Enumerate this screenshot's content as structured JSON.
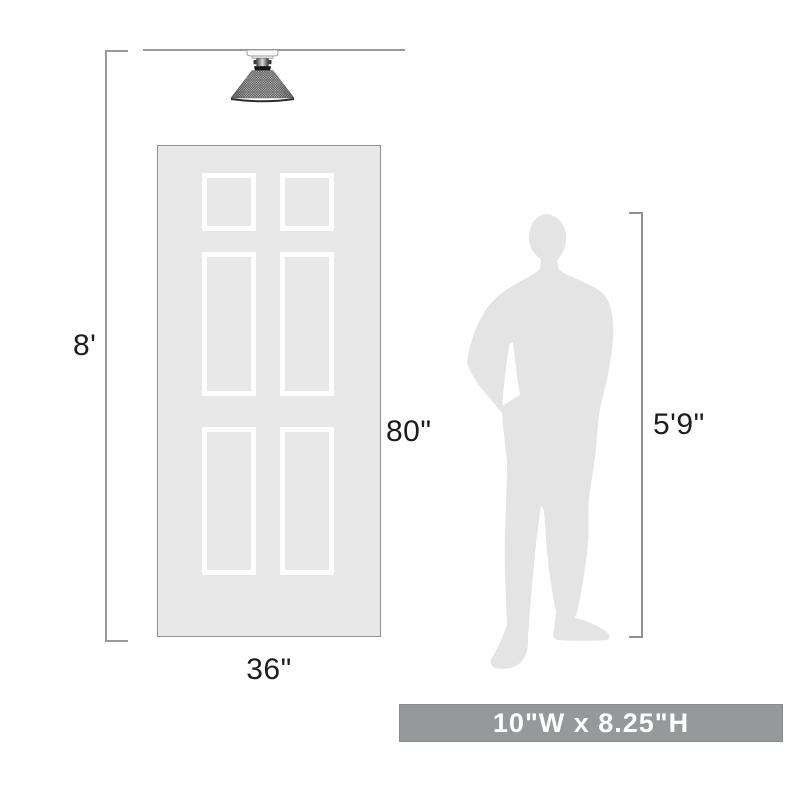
{
  "page": {
    "type": "product-dimension-scale-diagram"
  },
  "annotations": {
    "ceiling_height": "8'",
    "door_height": "80\"",
    "door_width": "36\"",
    "person_height": "5'9\""
  },
  "banner": {
    "product_dimensions": "10\"W x 8.25\"H"
  },
  "icons": {
    "light_fixture": "semi-flush-mount-mesh-cone-light",
    "door": "six-panel-interior-door",
    "person": "standing-man-silhouette"
  },
  "colors": {
    "background": "#ffffff",
    "door_fill": "#e8e8e8",
    "panel_stroke": "#ffffff",
    "silhouette_fill": "#e4e4e4",
    "dimension_line": "#9a9a9a",
    "label_text": "#1d1d1d",
    "banner_bg": "#97989a",
    "banner_text": "#ffffff",
    "shade_mesh": "#3f3f3f"
  }
}
